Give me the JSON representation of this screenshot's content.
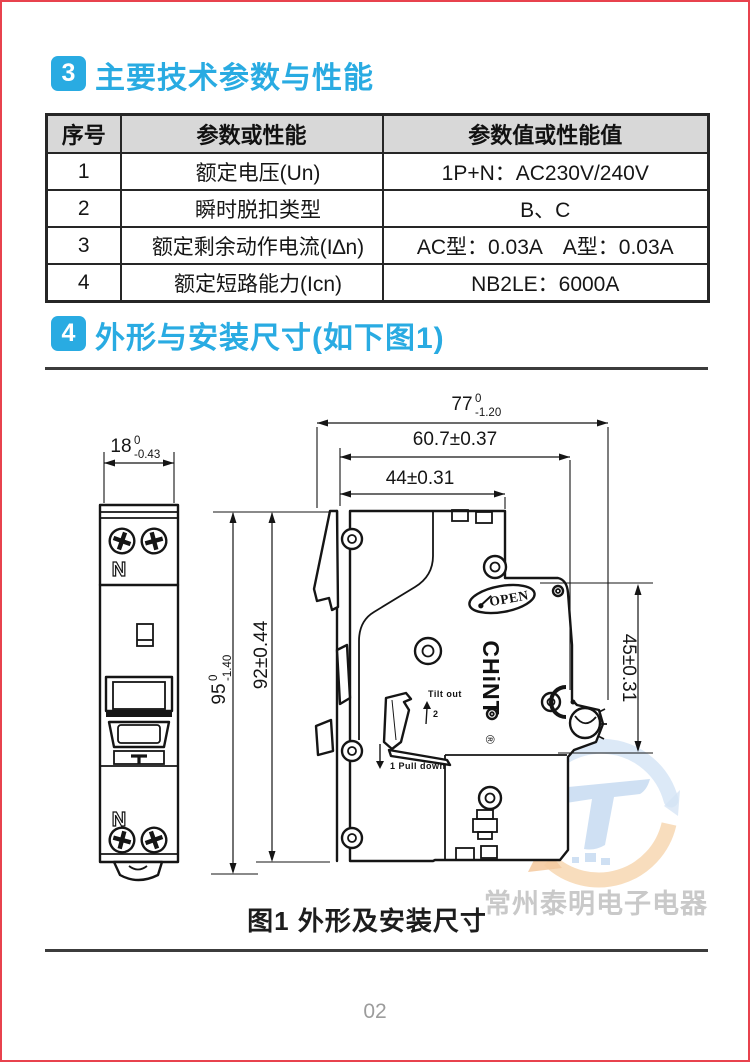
{
  "page": {
    "number": "02"
  },
  "colors": {
    "accent": "#29abe2",
    "page_border": "#e8424e",
    "table_header_bg": "#d8d8d8",
    "watermark_gray": "#c9c9c9"
  },
  "section3": {
    "badge": "3",
    "title": "主要技术参数与性能"
  },
  "table": {
    "headers": [
      "序号",
      "参数或性能",
      "参数值或性能值"
    ],
    "rows": [
      {
        "no": "1",
        "param": "额定电压(Un)",
        "value": "1P+N：AC230V/240V"
      },
      {
        "no": "2",
        "param": "瞬时脱扣类型",
        "value": "B、C"
      },
      {
        "no": "3",
        "param": "额定剩余动作电流(I∆n)",
        "value": "AC型：0.03A　A型：0.03A"
      },
      {
        "no": "4",
        "param": "额定短路能力(Icn)",
        "value": "NB2LE：6000A"
      }
    ]
  },
  "section4": {
    "badge": "4",
    "title": "外形与安装尺寸(如下图1)"
  },
  "figure": {
    "caption": "图1 外形及安装尺寸",
    "dims": {
      "d18": {
        "value": "18",
        "sup": "0",
        "sub": "-0.43"
      },
      "d77": {
        "value": "77",
        "sup": "0",
        "sub": "-1.20"
      },
      "d607": {
        "value": "60.7±0.37"
      },
      "d44": {
        "value": "44±0.31"
      },
      "d95": {
        "value": "95",
        "sup": "0",
        "sub": "-1.40"
      },
      "d92": {
        "value": "92±0.44"
      },
      "d45": {
        "value": "45±0.31"
      }
    },
    "labels": {
      "n_top": "N",
      "n_bottom": "N",
      "open": "OPEN",
      "brand": "CHiNT",
      "registered": "®",
      "tilt_out": "Tilt out",
      "step2": "2",
      "pull_down": "1 Pull down"
    }
  },
  "watermark": {
    "text": "常州泰明电子电器",
    "logo_letter": "T"
  }
}
